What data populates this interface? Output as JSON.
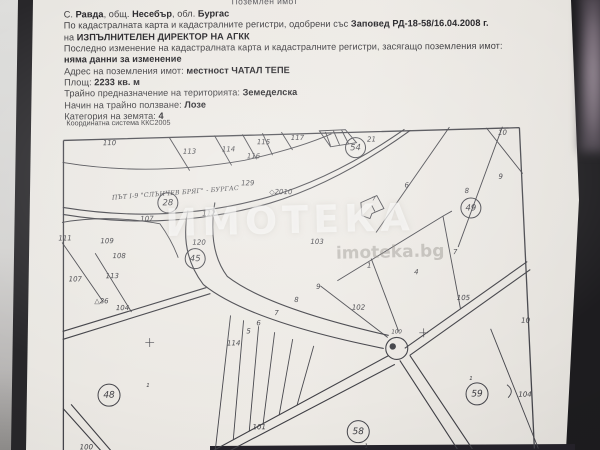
{
  "photo": {
    "paper_color": "#ece9e4",
    "folder_color": "#1d1c1f",
    "line_color": "#45454b"
  },
  "header": {
    "clipped_top_line": "Поземлен имот",
    "lines": [
      [
        {
          "t": "С. "
        },
        {
          "t": "Равда",
          "b": 1
        },
        {
          "t": ", общ. "
        },
        {
          "t": "Несебър",
          "b": 1
        },
        {
          "t": ", обл. "
        },
        {
          "t": "Бургас",
          "b": 1
        }
      ],
      [
        {
          "t": "По кадастралната карта и кадастралните регистри, одобрени със "
        },
        {
          "t": "Заповед РД-18-58/16.04.2008 г.",
          "b": 1
        }
      ],
      [
        {
          "t": "на "
        },
        {
          "t": "ИЗПЪЛНИТЕЛЕН ДИРЕКТОР НА АГКК",
          "b": 1
        }
      ],
      [
        {
          "t": "Последно изменение на кадастралната карта и кадастралните регистри, засягащо поземления имот:"
        }
      ],
      [
        {
          "t": "няма данни за изменение",
          "b": 1
        }
      ],
      [
        {
          "t": "Адрес на поземления имот: "
        },
        {
          "t": "местност ЧАТАЛ ТЕПЕ",
          "b": 1
        }
      ],
      [
        {
          "t": "Площ: "
        },
        {
          "t": "2233 кв. м",
          "b": 1
        }
      ],
      [
        {
          "t": "Трайно предназначение на територията: "
        },
        {
          "t": "Земеделска",
          "b": 1
        }
      ],
      [
        {
          "t": "Начин на трайно ползване: "
        },
        {
          "t": "Лозе",
          "b": 1
        }
      ],
      [
        {
          "t": "Категория на земята: "
        },
        {
          "t": "4",
          "b": 1
        }
      ]
    ]
  },
  "map": {
    "coord_system_label": "Координатна система ККС2005",
    "road_label": "ПЪТ I-9 \"СЛЪНЧЕВ БРЯГ\" - БУРГАС",
    "watermark": "ИМОТЕКА",
    "watermark_url": "imoteka.bg",
    "labels": [
      {
        "t": "110",
        "x": 110,
        "y": 142,
        "k": "p"
      },
      {
        "t": "113",
        "x": 190,
        "y": 151,
        "k": "p"
      },
      {
        "t": "114",
        "x": 229,
        "y": 149,
        "k": "p"
      },
      {
        "t": "115",
        "x": 264,
        "y": 142,
        "k": "p"
      },
      {
        "t": "116",
        "x": 254,
        "y": 156,
        "k": "p"
      },
      {
        "t": "117",
        "x": 298,
        "y": 138,
        "k": "p"
      },
      {
        "t": "21",
        "x": 372,
        "y": 140,
        "k": "p"
      },
      {
        "t": "10",
        "x": 503,
        "y": 134,
        "k": "p"
      },
      {
        "t": "9",
        "x": 501,
        "y": 178,
        "k": "p"
      },
      {
        "t": "8",
        "x": 467,
        "y": 192,
        "k": "p"
      },
      {
        "t": "6",
        "x": 407,
        "y": 186,
        "k": "p"
      },
      {
        "t": "7",
        "x": 374,
        "y": 200,
        "k": "ps"
      },
      {
        "t": "129",
        "x": 248,
        "y": 183,
        "k": "p"
      },
      {
        "t": "◇2010",
        "x": 281,
        "y": 192,
        "k": "p"
      },
      {
        "t": "112",
        "x": 209,
        "y": 213,
        "k": "p"
      },
      {
        "t": "107",
        "x": 147,
        "y": 218,
        "k": "p"
      },
      {
        "t": "111",
        "x": 65,
        "y": 237,
        "k": "p"
      },
      {
        "t": "109",
        "x": 107,
        "y": 240,
        "k": "p"
      },
      {
        "t": "108",
        "x": 119,
        "y": 255,
        "k": "p"
      },
      {
        "t": "113",
        "x": 112,
        "y": 275,
        "k": "p"
      },
      {
        "t": "107",
        "x": 75,
        "y": 278,
        "k": "p"
      },
      {
        "t": "120",
        "x": 199,
        "y": 242,
        "k": "p"
      },
      {
        "t": "103",
        "x": 317,
        "y": 242,
        "k": "p"
      },
      {
        "t": "1",
        "x": 369,
        "y": 266,
        "k": "p"
      },
      {
        "t": "4",
        "x": 416,
        "y": 273,
        "k": "p"
      },
      {
        "t": "7",
        "x": 455,
        "y": 253,
        "k": "p"
      },
      {
        "t": "102",
        "x": 358,
        "y": 308,
        "k": "p"
      },
      {
        "t": "105",
        "x": 463,
        "y": 299,
        "k": "p"
      },
      {
        "t": "100",
        "x": 396,
        "y": 333,
        "k": "ps"
      },
      {
        "t": "10",
        "x": 525,
        "y": 322,
        "k": "p"
      },
      {
        "t": "9",
        "x": 318,
        "y": 287,
        "k": "p"
      },
      {
        "t": "8",
        "x": 296,
        "y": 300,
        "k": "p"
      },
      {
        "t": "7",
        "x": 276,
        "y": 313,
        "k": "p"
      },
      {
        "t": "6",
        "x": 258,
        "y": 323,
        "k": "p"
      },
      {
        "t": "5",
        "x": 248,
        "y": 331,
        "k": "p"
      },
      {
        "t": "114",
        "x": 233,
        "y": 343,
        "k": "p"
      },
      {
        "t": "104",
        "x": 122,
        "y": 307,
        "k": "p"
      },
      {
        "t": "△26",
        "x": 101,
        "y": 300,
        "k": "p"
      },
      {
        "t": "101",
        "x": 258,
        "y": 427,
        "k": "p"
      },
      {
        "t": "104",
        "x": 524,
        "y": 396,
        "k": "p"
      },
      {
        "t": "1",
        "x": 470,
        "y": 380,
        "k": "ps"
      },
      {
        "t": "1",
        "x": 147,
        "y": 385,
        "k": "ps"
      },
      {
        "t": "1",
        "x": 365,
        "y": 447,
        "k": "ps"
      },
      {
        "t": "100",
        "x": 85,
        "y": 446,
        "k": "p"
      },
      {
        "t": "54",
        "x": 356,
        "y": 148,
        "k": "c"
      },
      {
        "t": "28",
        "x": 168,
        "y": 202,
        "k": "c"
      },
      {
        "t": "45",
        "x": 195,
        "y": 258,
        "k": "c"
      },
      {
        "t": "49",
        "x": 471,
        "y": 209,
        "k": "c"
      },
      {
        "t": "48",
        "x": 108,
        "y": 394,
        "k": "cb"
      },
      {
        "t": "59",
        "x": 476,
        "y": 395,
        "k": "cb"
      },
      {
        "t": "58",
        "x": 357,
        "y": 432,
        "k": "cb"
      },
      {
        "t": "+",
        "x": 149,
        "y": 342,
        "k": "x"
      },
      {
        "t": "+",
        "x": 423,
        "y": 334,
        "k": "x"
      }
    ]
  }
}
